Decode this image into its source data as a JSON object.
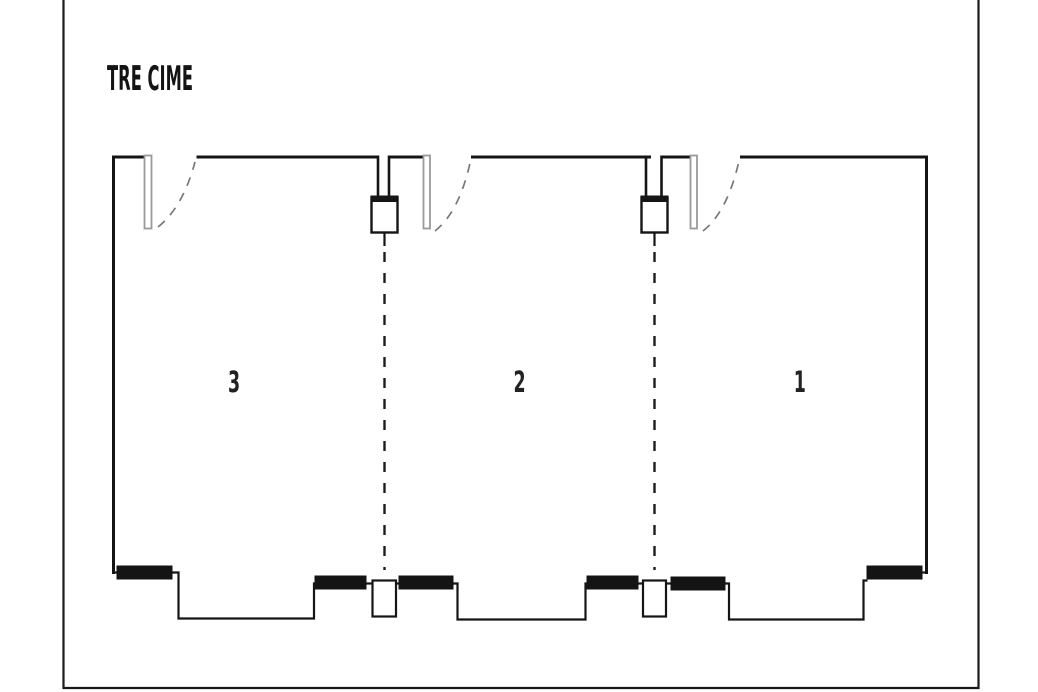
{
  "title": "TRE CIME",
  "rooms": [
    {
      "label": "3"
    },
    {
      "label": "2"
    },
    {
      "label": "1"
    }
  ],
  "colors": {
    "line": "#151515",
    "background": "#ffffff",
    "door_leaf": "#9a9a9a",
    "window_fill": "#141414"
  }
}
